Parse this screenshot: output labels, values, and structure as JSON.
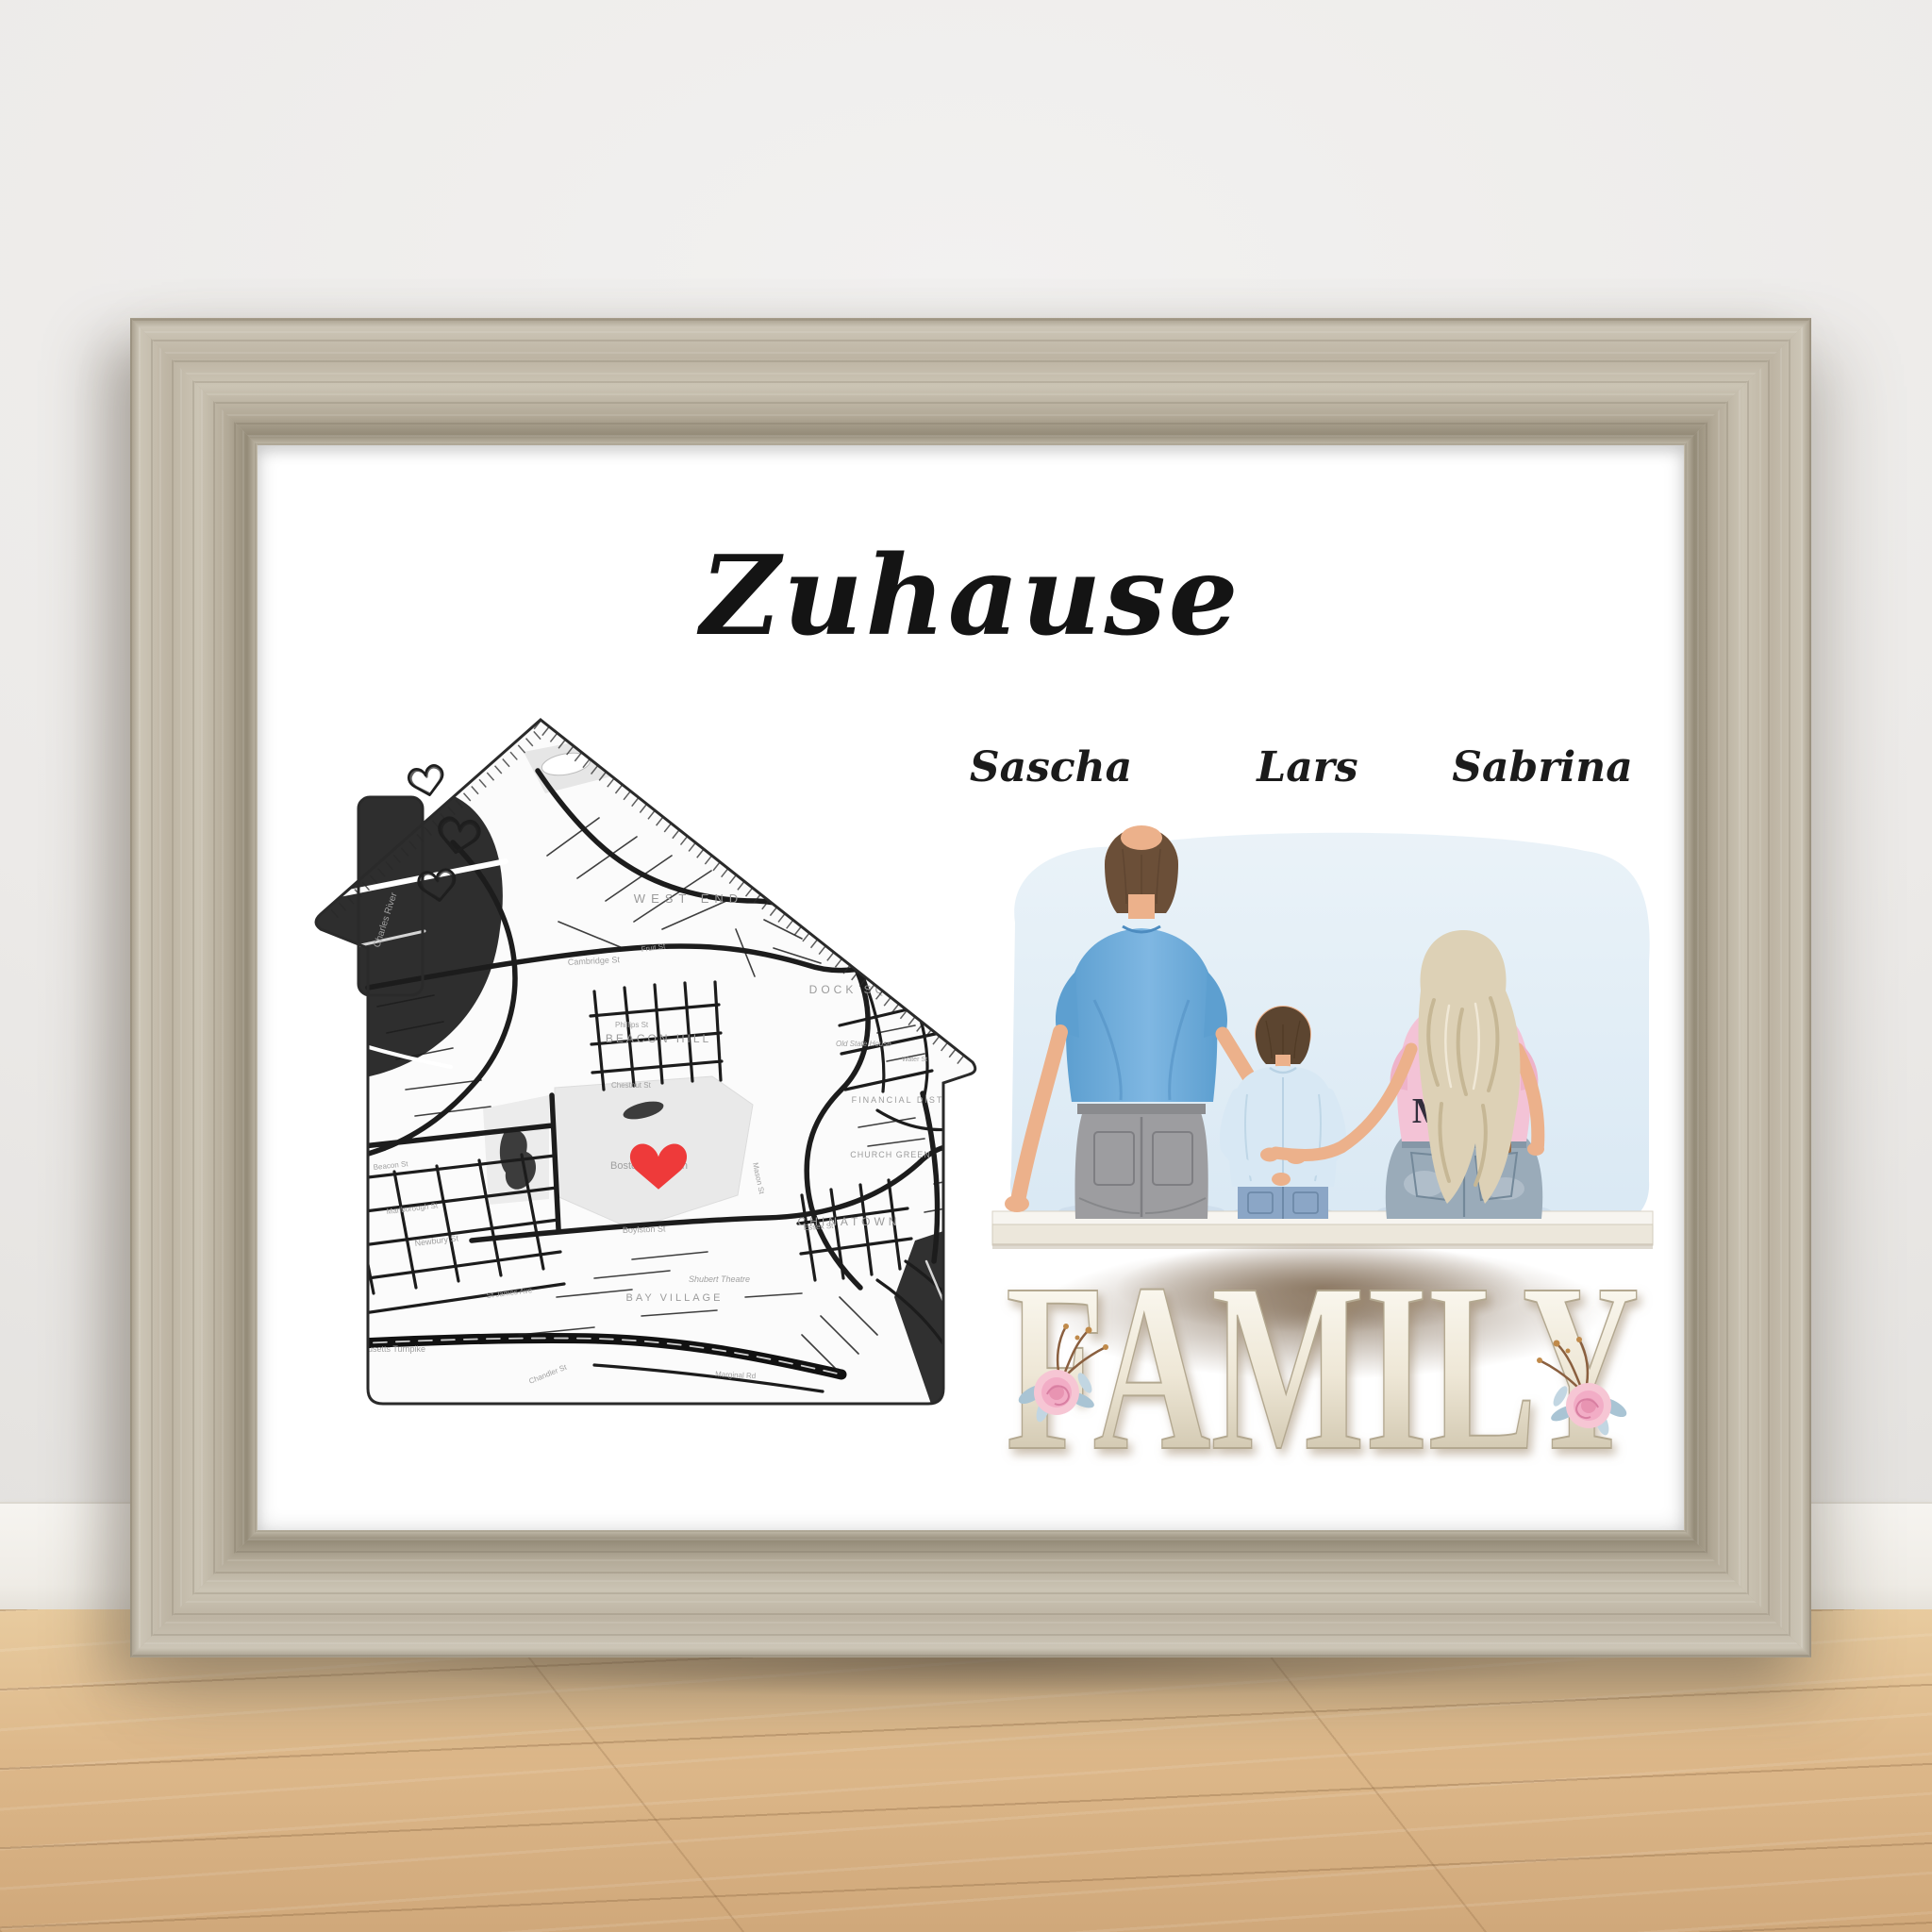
{
  "scene": {
    "description": "Personalized family wall-art print in a rustic grey wood frame, leaning against a white wall on a light oak floor",
    "colors": {
      "wall": "#ebeae8",
      "baseboard": "#f4f2ee",
      "floor_wood": "#ddb98c",
      "frame_wood": "#bdb5a5",
      "print_background": "#ffffff"
    }
  },
  "print": {
    "title": "Zuhause",
    "names": {
      "left": "Sascha",
      "middle": "Lars",
      "right": "Sabrina"
    },
    "family_sign": "FAMILY",
    "mom_shirt_text": "MOM",
    "map": {
      "shape": "house silhouette with chimney and three sketched hearts",
      "city": "Boston",
      "marker": "red heart over Boston Common",
      "marker_color": "#ee3a3a",
      "labels": {
        "west_end": "WEST END",
        "beacon_hill": "BEACON HILL",
        "dock_square": "DOCK SQUARE",
        "financial_district": "FINANCIAL DISTRICT",
        "church_green": "CHURCH GREEN",
        "chinatown": "CHINATOWN",
        "bay_village": "BAY VILLAGE",
        "boston_common": "Boston Common",
        "charles_river": "Charles River",
        "fort_point_channel": "Fort Point Channel",
        "cambridge_st": "Cambridge St",
        "chestnut_st": "Chestnut St",
        "phillips_st": "Phillips St",
        "fruit_st": "Fruit St",
        "boylston_st": "Boylston St",
        "newbury_st": "Newbury St",
        "marlborough_st": "Marlborough St",
        "beacon_st": "Beacon St",
        "st_james_ave": "St James Ave",
        "essex_st": "Essex St",
        "mason_st": "Mason St",
        "marginal_rd": "Marginal Rd",
        "chandler_st": "Chandler St",
        "mass_turnpike": "Massachusetts Turnpike",
        "shubert_theatre": "Shubert Theatre",
        "old_state_house": "Old State House",
        "water_st": "Water St"
      }
    },
    "illustration": {
      "father": "man with balding brown hair, blue t-shirt, grey jeans",
      "son": "boy with brown hair, light blue shirt, blue jeans",
      "mother": "woman with long wavy blonde hair, pink MOM t-shirt, blue jeans",
      "colors": {
        "father_shirt": "#69a8d6",
        "son_shirt": "#d8e8f4",
        "mother_shirt": "#f3c3d6",
        "watercolor_background": "#dce9f4",
        "bench": "#f3efe6"
      }
    }
  }
}
